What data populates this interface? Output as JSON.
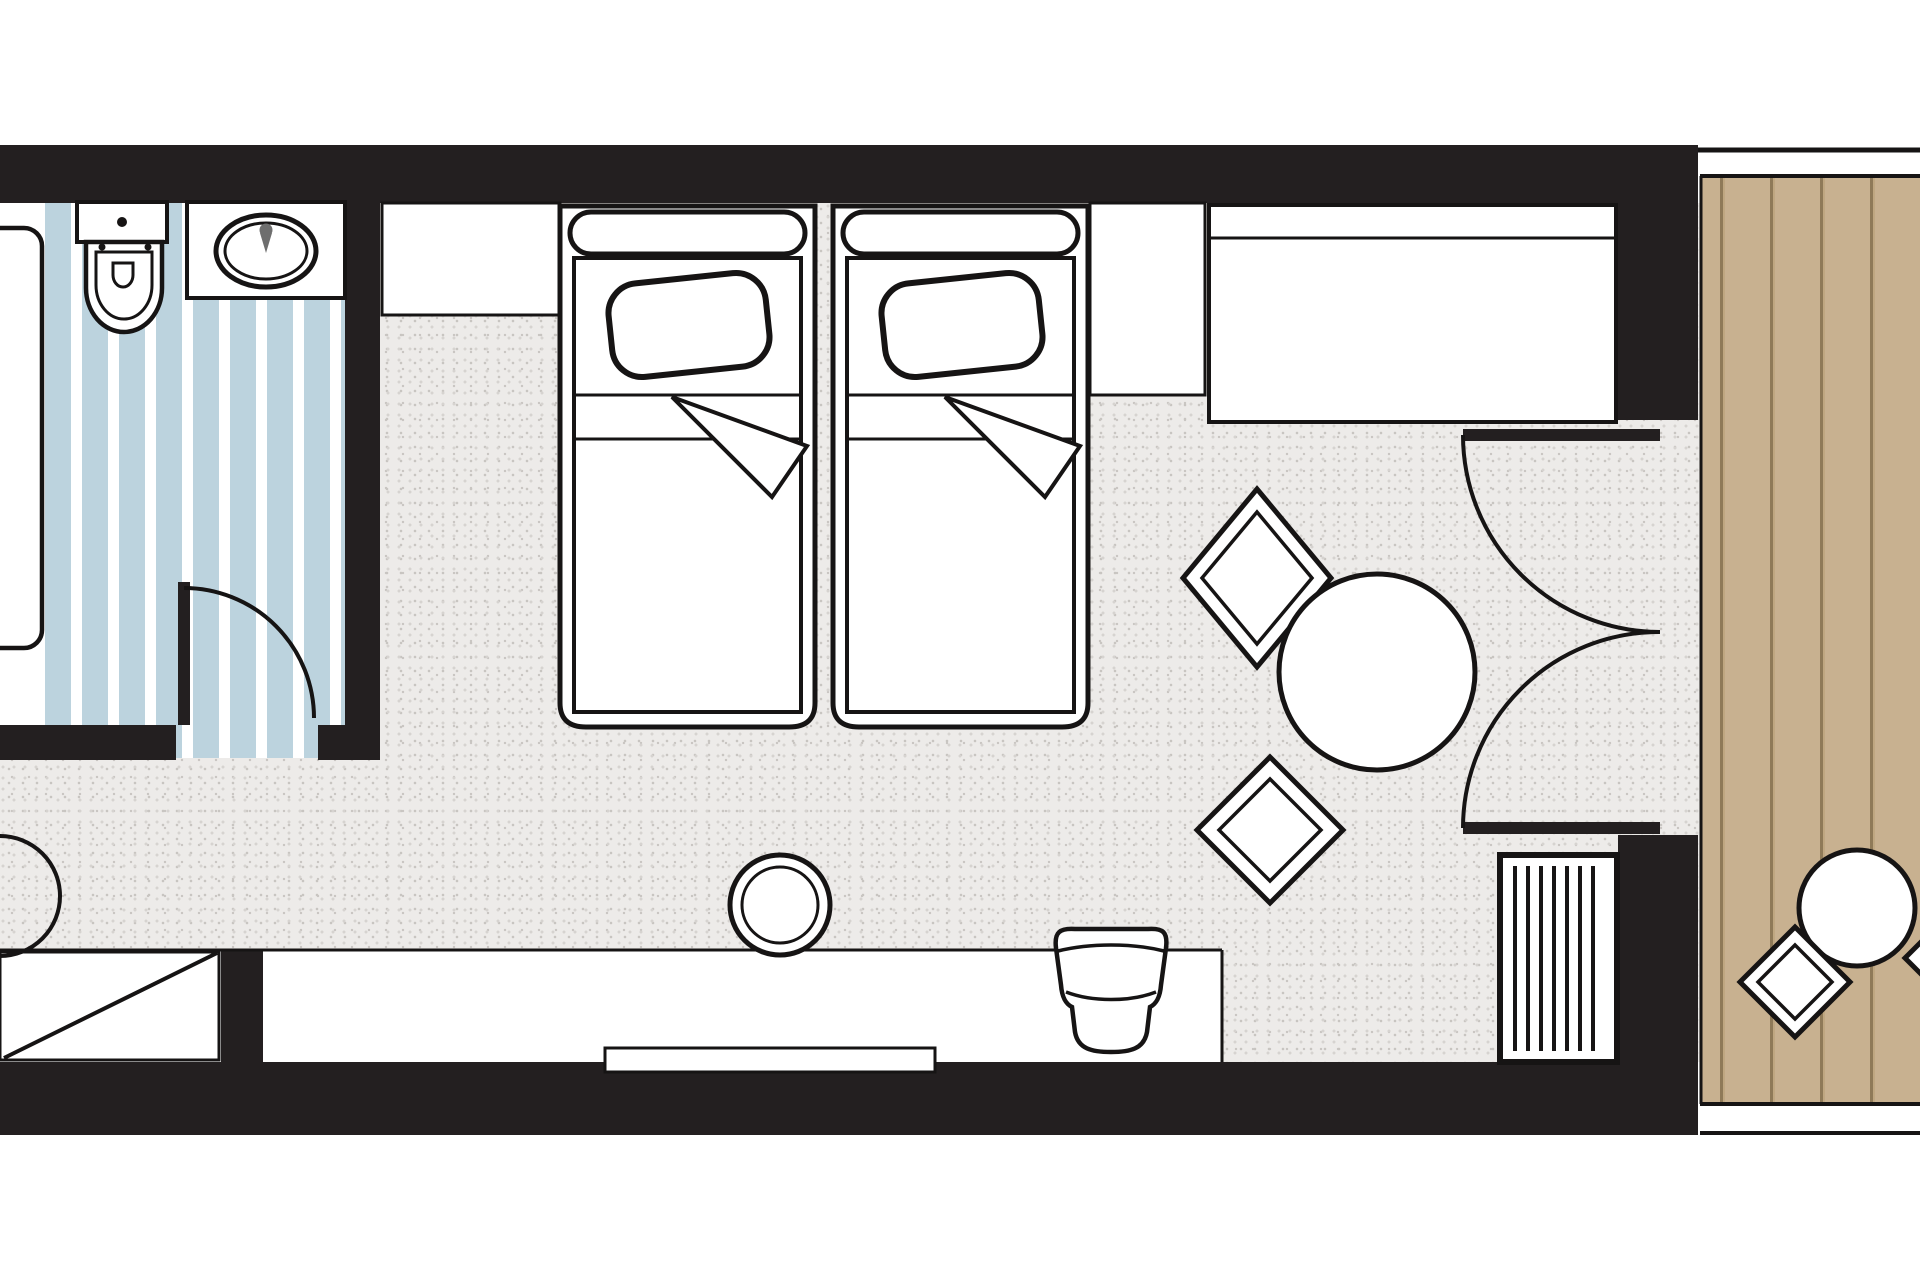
{
  "diagram": {
    "type": "floor-plan",
    "subject": "hotel guest room: bathroom, twin-bed bedroom, lounge corner and wooden balcony",
    "text_labels": []
  },
  "colors": {
    "wall": "#231f20",
    "outline": "#161414",
    "floor_base": "#edebe9",
    "floor_dot1": "#d6d3d0",
    "floor_dot2": "#c8c5c1",
    "floor_dot3": "#dfddda",
    "bath_blue": "#bcd3de",
    "wood_base": "#c8b190",
    "wood_dark": "#8f7a58",
    "wood_light": "#bfa781",
    "faucet_gray": "#6e6e6e"
  },
  "rooms": [
    {
      "name": "bathroom",
      "floor": "blue striped tile",
      "furniture": [
        "bathtub",
        "toilet",
        "sink-vanity",
        "hinged-door"
      ]
    },
    {
      "name": "bedroom",
      "floor": "speckled carpet",
      "furniture": [
        "closet",
        "twin-bed-1",
        "twin-bed-2",
        "nightstand",
        "sofa",
        "round-table",
        "lounge-chair-upper",
        "lounge-chair-lower",
        "desk",
        "desk-stool",
        "desk-chair",
        "tv",
        "luggage-rack",
        "louver-cabinet",
        "french-balcony-doors",
        "entrance-door"
      ]
    },
    {
      "name": "balcony",
      "floor": "wood deck",
      "furniture": [
        "outdoor-table",
        "outdoor-chair",
        "outdoor-chair-partial"
      ]
    }
  ]
}
